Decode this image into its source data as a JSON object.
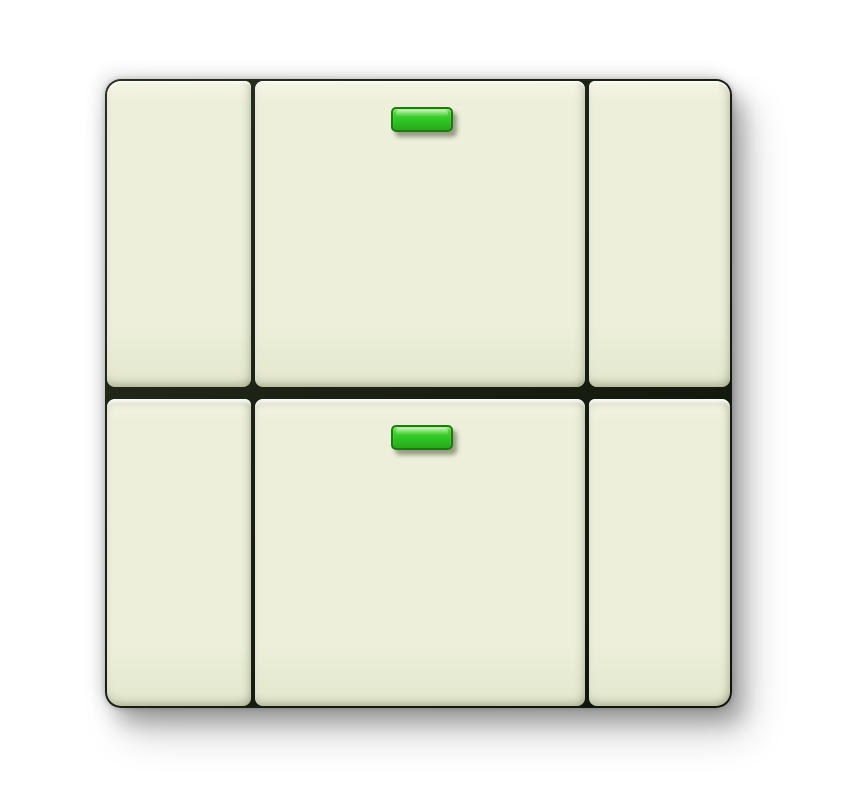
{
  "scene": {
    "description": "Product photo of an ivory two-gang wall push-button switch; each row has a narrow left rocker, a wide centre rocker with a green status LED, and a narrow right rocker",
    "rows": 2,
    "columns": 3
  },
  "theme": {
    "background": "#ffffff",
    "plate-face": "#edefda",
    "plate-face-light": "#f5f6e6",
    "plate-face-dark": "#e3e7cc",
    "plate-line": "#1a2013",
    "led-green": "#2fc424",
    "led-green-deep": "#28a81c",
    "led-green-light": "#7ce455",
    "led-border": "#1b7a10"
  },
  "rockers": [
    {
      "id": "top-left",
      "row": "top",
      "column": "left",
      "has_led": false
    },
    {
      "id": "top-center",
      "row": "top",
      "column": "center",
      "has_led": true,
      "led_state": "on",
      "led_color": "green"
    },
    {
      "id": "top-right",
      "row": "top",
      "column": "right",
      "has_led": false
    },
    {
      "id": "bottom-left",
      "row": "bottom",
      "column": "left",
      "has_led": false
    },
    {
      "id": "bottom-center",
      "row": "bottom",
      "column": "center",
      "has_led": true,
      "led_state": "on",
      "led_color": "green"
    },
    {
      "id": "bottom-right",
      "row": "bottom",
      "column": "right",
      "has_led": false
    }
  ],
  "leds": {
    "count": 2,
    "color_name": "green",
    "state": "on"
  }
}
